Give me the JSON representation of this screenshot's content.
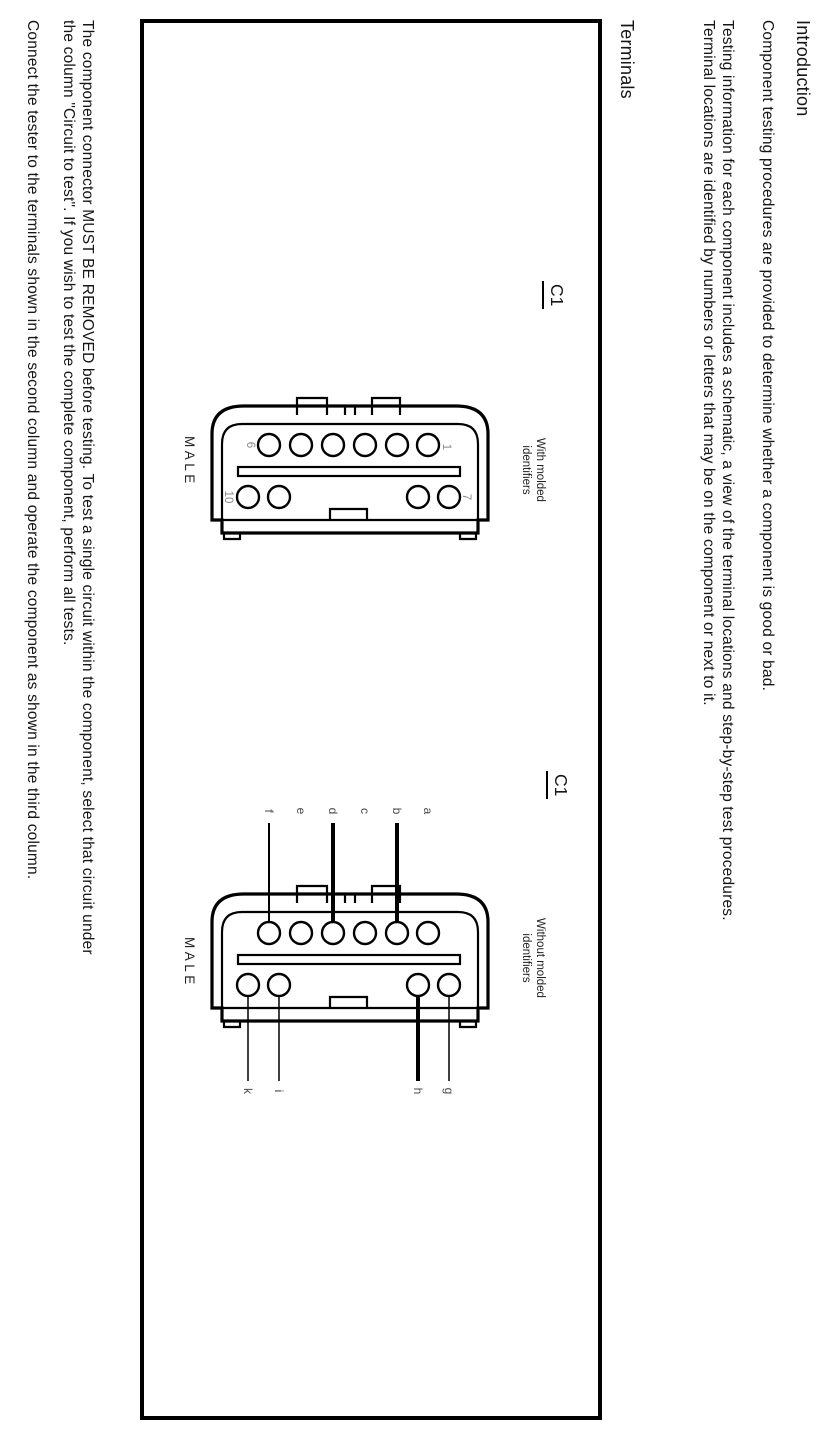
{
  "page": {
    "intro_heading": "Introduction",
    "paragraphs": [
      "Component testing procedures are provided to determine whether a component is good or bad.",
      "Testing information for each component includes a schematic, a view of the terminal locations and step-by-step test procedures.",
      "Terminal locations are identified by numbers or letters that may be on the component or next to it."
    ],
    "terminals_heading": "Terminals",
    "figure": {
      "connector1": {
        "label": "C1",
        "caption_line1": "With molded",
        "caption_line2": "identifiers",
        "gender": "MALE",
        "pins": {
          "top_left": "6",
          "top_right": "1",
          "bottom_left": "10",
          "bottom_right": "7"
        }
      },
      "connector2": {
        "label": "C1",
        "caption_line1": "Without molded",
        "caption_line2": "identifiers",
        "gender": "MALE",
        "top_letters": [
          "f",
          "e",
          "d",
          "c",
          "b",
          "a"
        ],
        "bottom_letters": [
          "k",
          "i",
          "h",
          "g"
        ]
      }
    },
    "bottom_paragraphs": [
      [
        "The component connector MUST BE REMOVED before testing. To test a single circuit within the component, select that circuit under",
        "the column \"Circuit to test\". If you wish to test the complete component, perform all tests."
      ],
      [
        "Connect the tester to the terminals shown in the second column and operate the component as shown in the third column."
      ]
    ]
  },
  "colors": {
    "ink": "#161616",
    "line": "#000000",
    "muted": "#8a8a8a",
    "background": "#ffffff"
  }
}
